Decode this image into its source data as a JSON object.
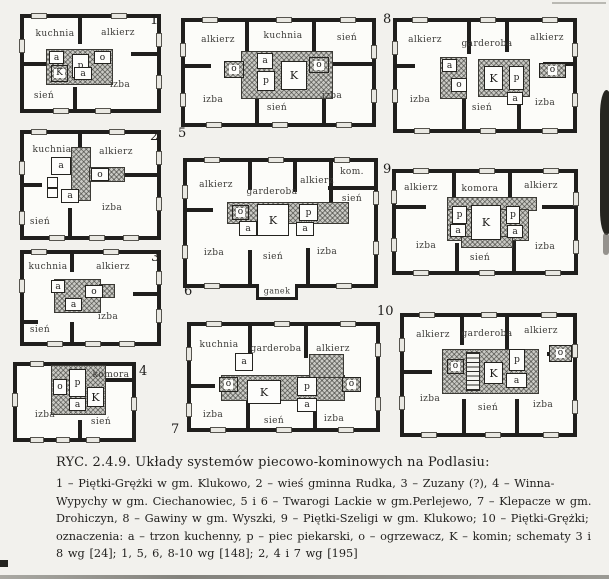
{
  "figure_caption": {
    "label": "RYC. 2.4.9.",
    "title": "Układy systemów piecowo-kominowych na Podlasiu:",
    "lines": [
      "1 – Piętki-Grężki w gm. Klukowo, 2 – wieś gminna Rudka, 3 – Zuzany (?), 4 – Winna-",
      "Wypychy w gm. Ciechanowiec, 5 i 6 – Twarogi Lackie w gm.Perlejewo, 7 – Klepacze w gm.",
      "Drohiczyn, 8 – Gawiny w gm. Wyszki, 9 – Piętki-Szeligi w gm. Klukowo; 10 – Piętki-Grężki;",
      "oznaczenia: a – trzon kuchenny, p – piec piekarski, o – ogrzewacz, K – komin; schematy 3 i",
      "8 wg [24]; 1, 5, 6, 8-10 wg [148]; 2, 4 i 7 wg [195]"
    ]
  },
  "legend_colors": {
    "wall": "#201f1d",
    "hatch": "#c9c9c4",
    "paper": "#f2f1ed"
  },
  "plans": [
    {
      "number": "1",
      "rooms": [
        "kuchnia",
        "alkierz",
        "izba",
        "sień"
      ],
      "units": [
        "a",
        "p",
        "o",
        "a",
        "K"
      ]
    },
    {
      "number": "2",
      "rooms": [
        "kuchnia",
        "alkierz",
        "izba",
        "sień"
      ],
      "units": [
        "a",
        "o",
        "a"
      ]
    },
    {
      "number": "3",
      "rooms": [
        "kuchnia",
        "alkierz",
        "izba",
        "sień"
      ],
      "units": [
        "a",
        "o",
        "a"
      ]
    },
    {
      "number": "4",
      "rooms": [
        "komora",
        "izba",
        "sień"
      ],
      "units": [
        "o",
        "p",
        "a",
        "K"
      ]
    },
    {
      "number": "5",
      "rooms": [
        "alkierz",
        "kuchnia",
        "sień",
        "izba",
        "sień",
        "izba"
      ],
      "units": [
        "o",
        "a",
        "p",
        "K",
        "o"
      ]
    },
    {
      "number": "6",
      "rooms": [
        "alkierz",
        "garderoba",
        "alkierz",
        "kom.",
        "sień",
        "izba",
        "sień",
        "izba",
        "ganek"
      ],
      "units": [
        "o",
        "K",
        "p",
        "a",
        "a"
      ]
    },
    {
      "number": "7",
      "rooms": [
        "kuchnia",
        "garderoba",
        "alkierz",
        "izba",
        "sień",
        "izba"
      ],
      "units": [
        "a",
        "o",
        "K",
        "p",
        "a",
        "o"
      ]
    },
    {
      "number": "8",
      "rooms": [
        "alkierz",
        "garderoba",
        "alkierz",
        "izba",
        "sień",
        "izba"
      ],
      "units": [
        "a",
        "o",
        "K",
        "p",
        "a",
        "o"
      ]
    },
    {
      "number": "9",
      "rooms": [
        "alkierz",
        "komora",
        "alkierz",
        "izba",
        "sień",
        "izba"
      ],
      "units": [
        "p",
        "K",
        "p",
        "a",
        "a"
      ]
    },
    {
      "number": "10",
      "rooms": [
        "alkierz",
        "garderoba",
        "alkierz",
        "izba",
        "sień",
        "izba"
      ],
      "units": [
        "o",
        "K",
        "p",
        "a",
        "o"
      ]
    }
  ]
}
